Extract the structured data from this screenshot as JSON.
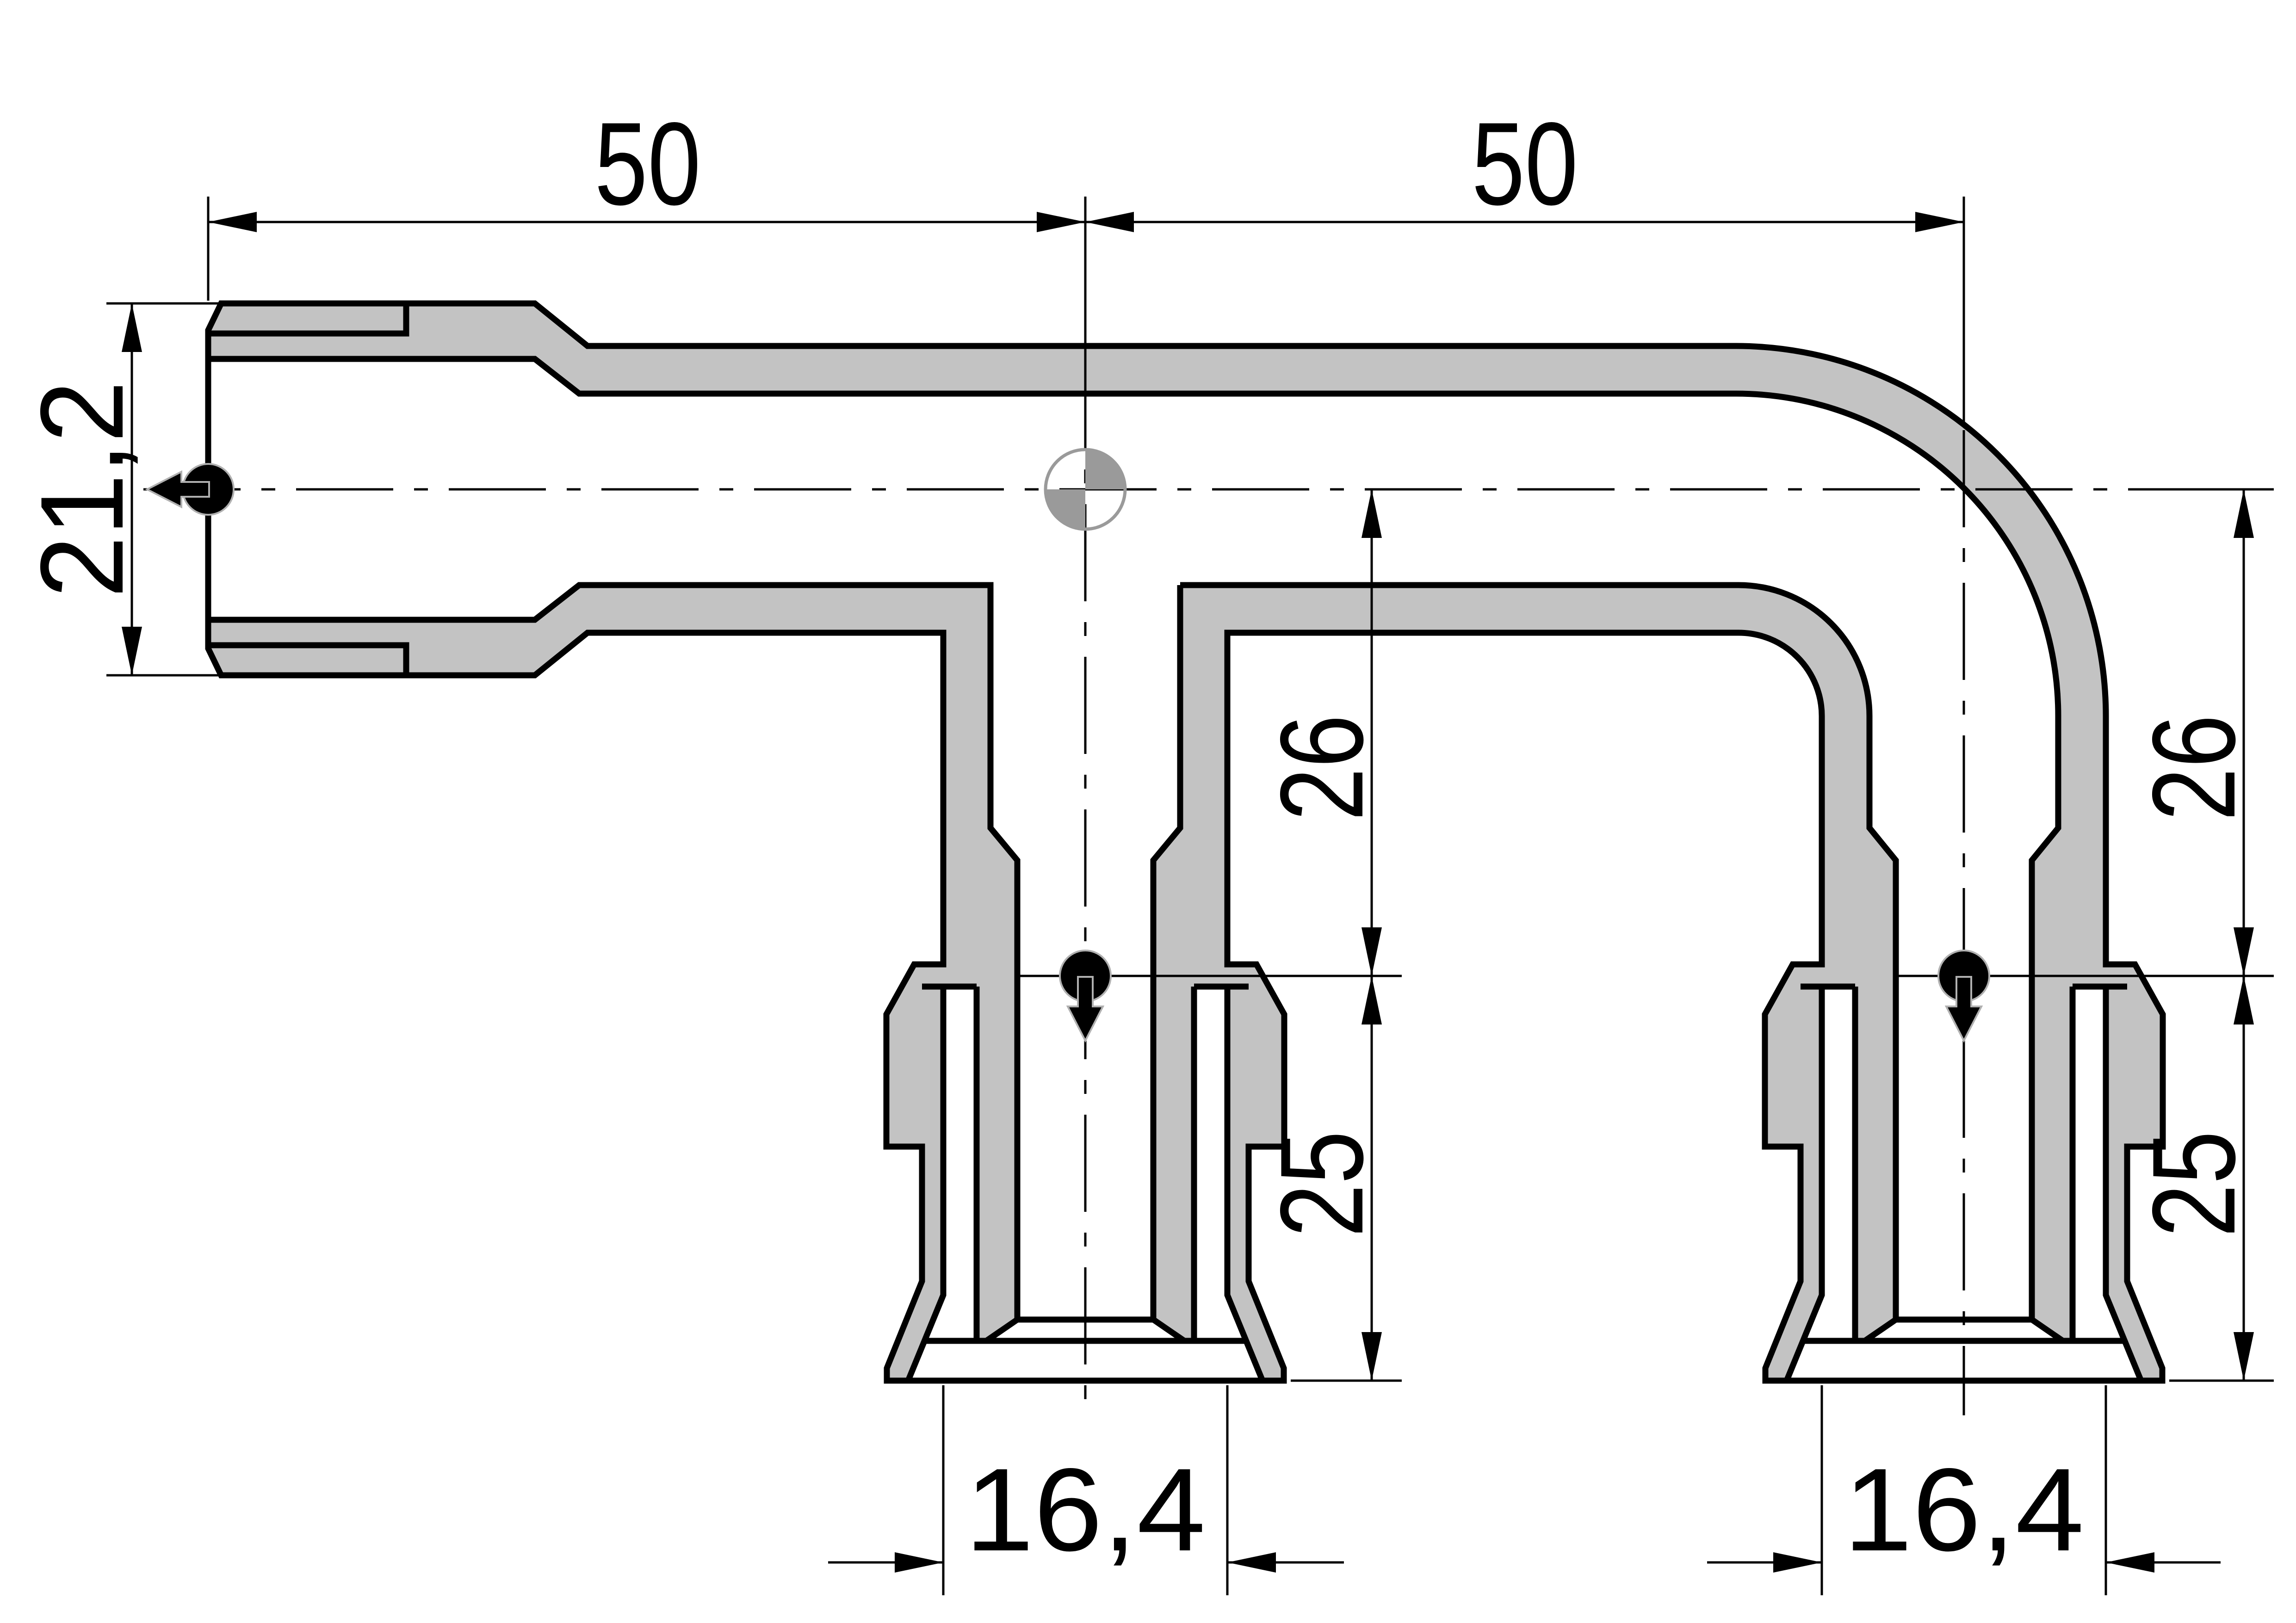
{
  "drawing": {
    "colors": {
      "background": "#ffffff",
      "line": "#000000",
      "section_fill": "#c3c3c3",
      "centroid": "#9a9a9a"
    },
    "dimensions": {
      "length_left": "50",
      "length_right": "50",
      "socket_outer_diameter": "21,2",
      "mid_branch_offset": "26",
      "right_branch_offset": "26",
      "mid_insertion_depth": "25",
      "right_insertion_depth": "25",
      "mid_pipe_diameter": "16,4",
      "right_pipe_diameter": "16,4"
    }
  }
}
